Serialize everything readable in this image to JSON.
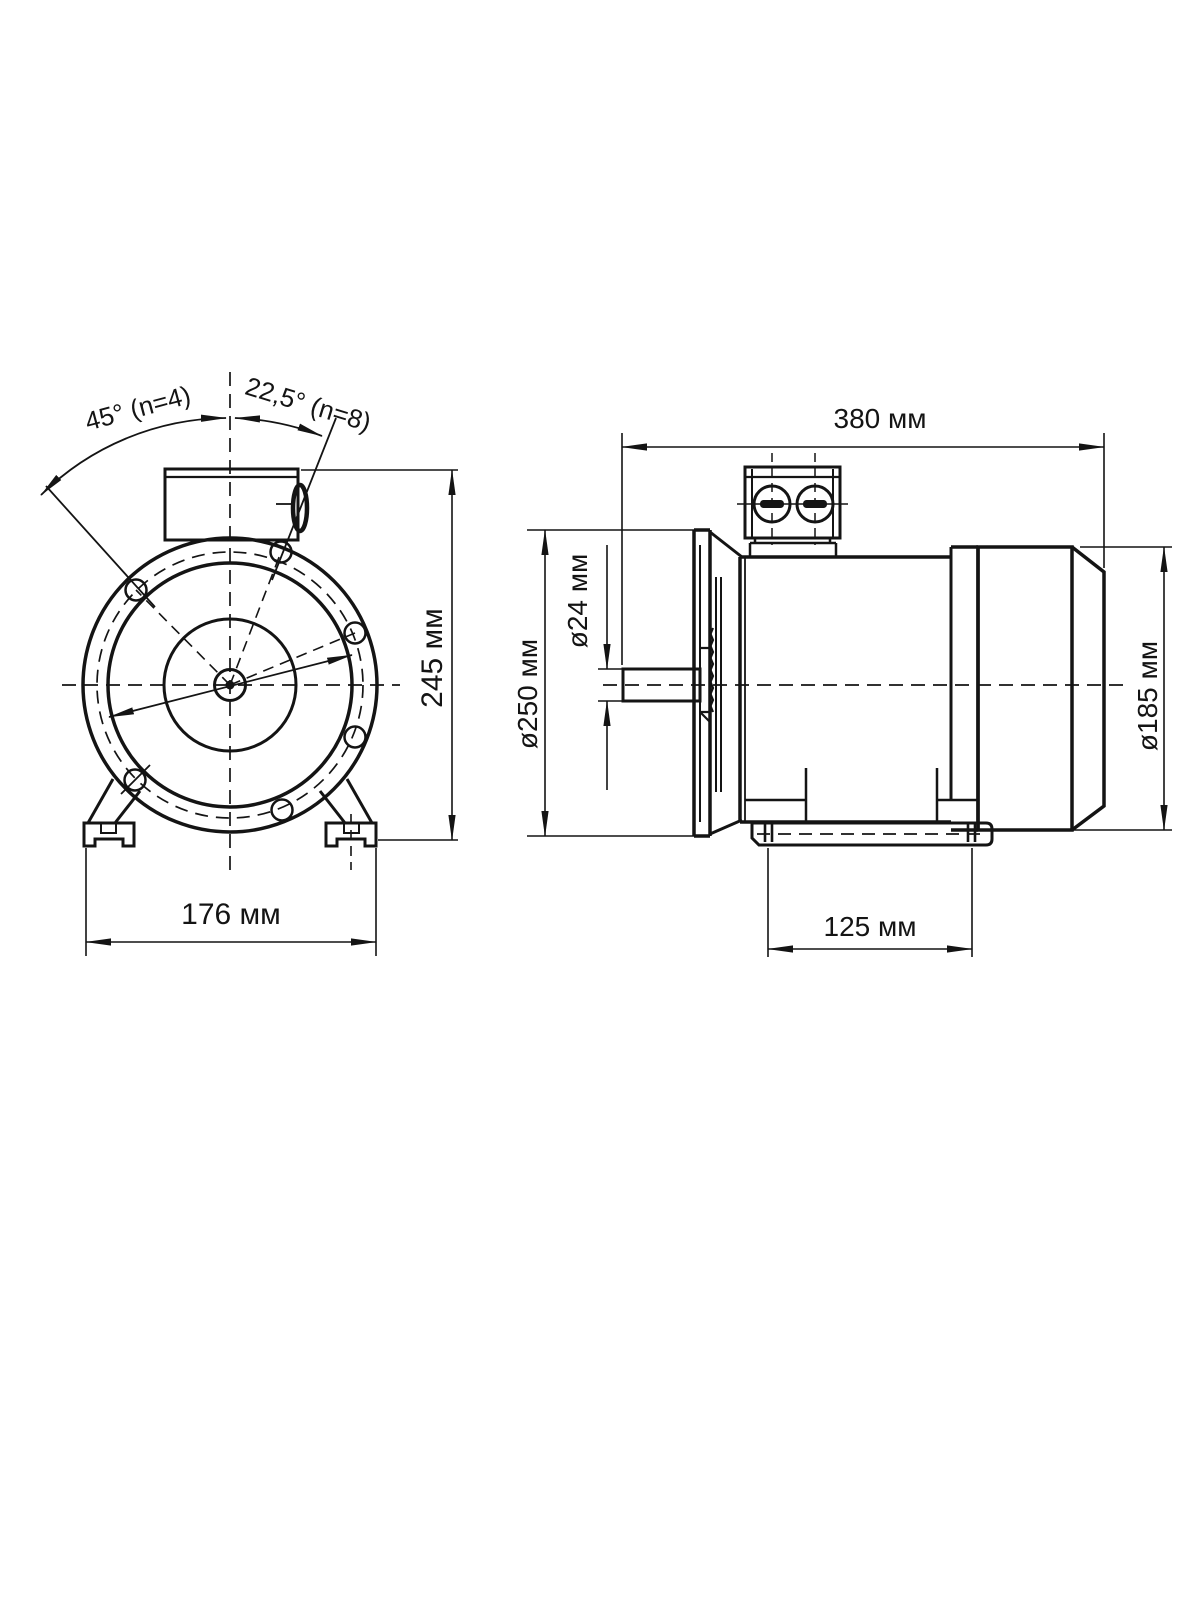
{
  "page": {
    "background": "#ffffff",
    "line_color": "#141414"
  },
  "front_view": {
    "angle_n4": "45° (n=4)",
    "angle_n8": "22,5° (n=8)",
    "height": "245 мм",
    "foot_width": "176 мм"
  },
  "side_view": {
    "length": "380 мм",
    "flange_diameter": "ø250 мм",
    "shaft_diameter": "ø24 мм",
    "housing_diameter": "ø185 мм",
    "foot_spacing": "125 мм"
  }
}
